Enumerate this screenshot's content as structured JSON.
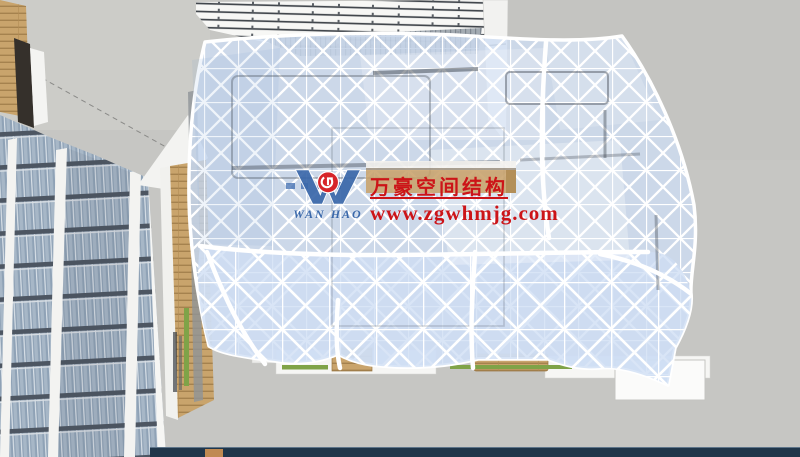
{
  "watermark": {
    "logo_text": "WAN HAO",
    "company_name": "万豪空间结构",
    "website": "www.zgwhmjg.com"
  },
  "colors": {
    "wm-red": "#cc1418",
    "wm-blue": "#3a68aa",
    "glass": "#cfdef4",
    "ground": "#c6c6c3",
    "wood": "#c9a46c",
    "tower-glass": "#8fa2b6",
    "hedge-green": "#7fa348",
    "footer-navy": "#20364a"
  }
}
